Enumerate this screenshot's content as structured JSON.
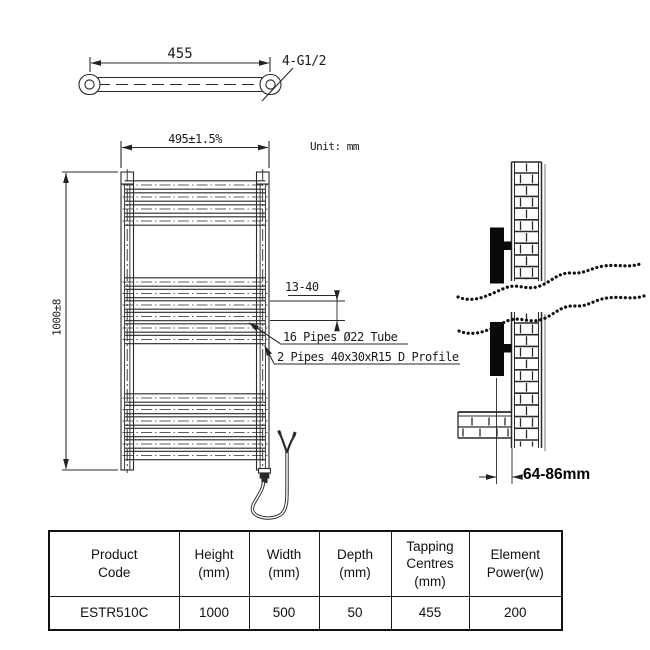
{
  "drawing": {
    "unit_note": "Unit: mm",
    "top_view": {
      "width_dim": "455",
      "fitting_label": "4-G1/2"
    },
    "front_view": {
      "width_dim": "495±1.5%",
      "height_dim": "1000±8",
      "rung_gap_dim": "13-40",
      "pipes_label": "16 Pipes Ø22 Tube",
      "profile_label": "2 Pipes 40x30xR15 D Profile"
    },
    "side_view": {
      "wall_distance_dim": "64-86mm"
    }
  },
  "table": {
    "headers": [
      "Product\nCode",
      "Height\n(mm)",
      "Width\n(mm)",
      "Depth\n(mm)",
      "Tapping\nCentres\n(mm)",
      "Element\nPower(w)"
    ],
    "row": [
      "ESTR510C",
      "1000",
      "500",
      "50",
      "455",
      "200"
    ]
  },
  "colors": {
    "line": "#2a2a2a",
    "solid_fill": "#0a0a0a",
    "shadow": "#aaaaaa"
  }
}
